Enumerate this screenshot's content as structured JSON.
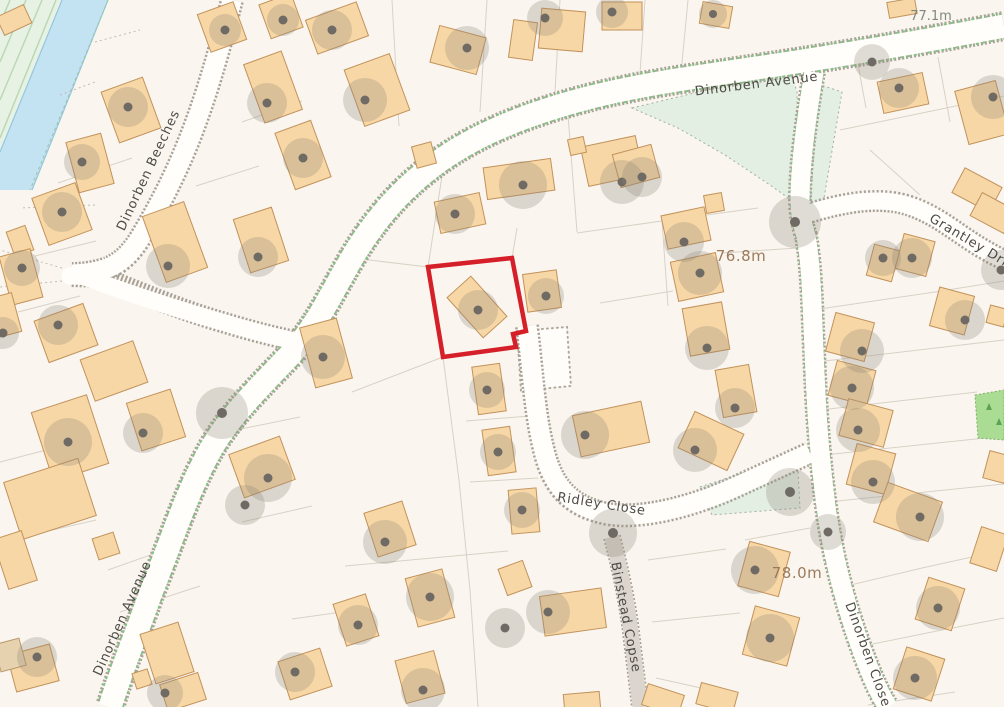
{
  "map": {
    "description": "OS-style residential street map with red property boundary outline",
    "streets": [
      {
        "id": "dinorben-beeches",
        "label": "Dinorben Beeches"
      },
      {
        "id": "dinorben-avenue-top",
        "label": "Dinorben Avenue"
      },
      {
        "id": "dinorben-avenue-left",
        "label": "Dinorben Avenue"
      },
      {
        "id": "grantley-drive",
        "label": "Grantley Drive"
      },
      {
        "id": "ridley-close",
        "label": "Ridley Close"
      },
      {
        "id": "binstead-copse",
        "label": "Binstead Copse"
      },
      {
        "id": "dinorben-close",
        "label": "Dinorben Close"
      }
    ],
    "spot_heights": [
      {
        "label": "77.1m",
        "color": "#7f887b"
      },
      {
        "label": "76.8m",
        "color": "#9b7a5c"
      },
      {
        "label": "78.0m",
        "color": "#9b7a5c"
      }
    ],
    "colors": {
      "boundary_red": "#d5202a",
      "building_fill": "#f7d7a5",
      "building_stroke": "#c2925c",
      "road_surface": "#fffefb",
      "road_edge": "#a8a198",
      "verge_green": "#e3efe2",
      "grass_green": "#abdc93",
      "stream_blue": "#c3e2f2",
      "street_label": "#4d4b47",
      "background": "#faf6ef"
    }
  }
}
